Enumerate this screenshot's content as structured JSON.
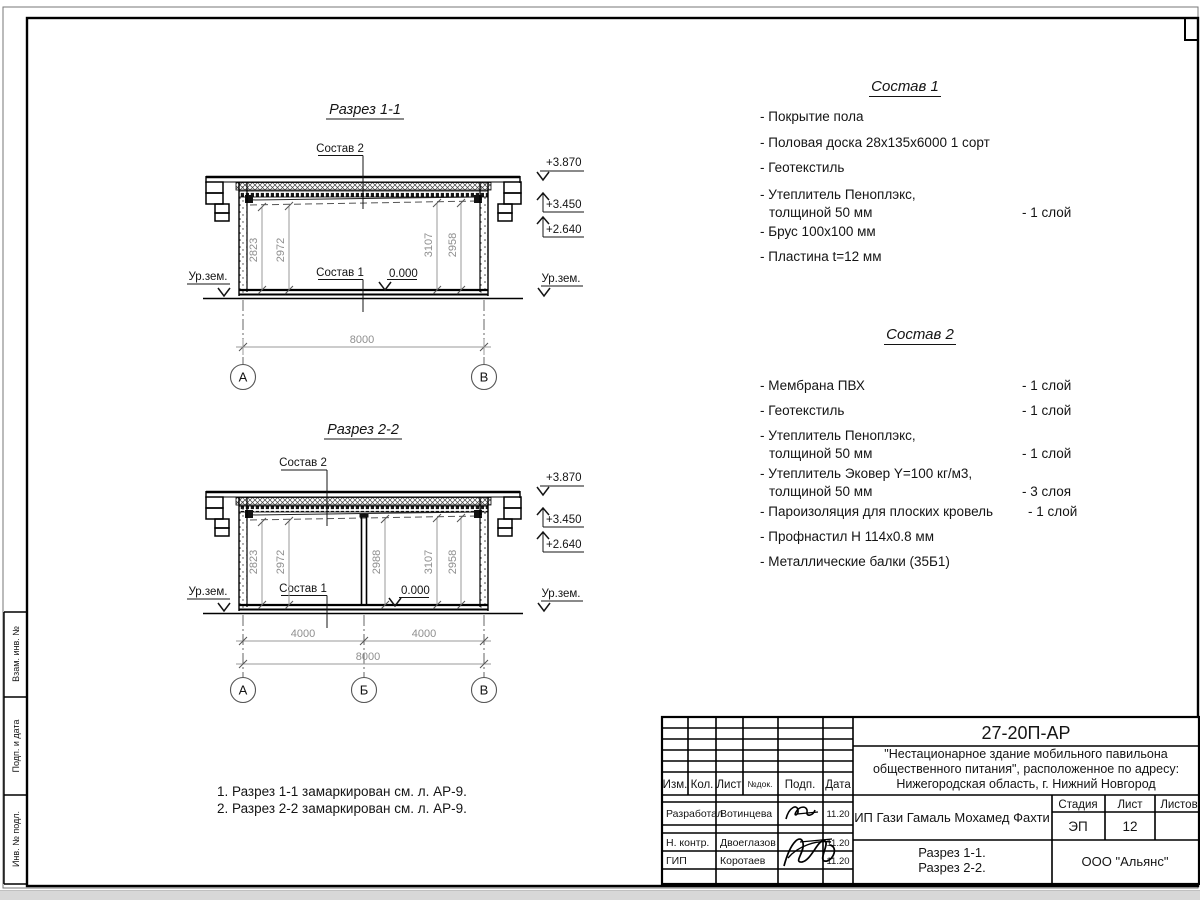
{
  "margin_labels": [
    "Взам. инв. №",
    "Подп. и дата",
    "Инв. № подл."
  ],
  "sections": [
    {
      "title": "Разрез 1-1",
      "sostav2": "Состав 2",
      "sostav1": "Состав 1",
      "zero": "0.000",
      "ground_left": "Ур.зем.",
      "ground_right": "Ур.зем.",
      "elevations": [
        "+3.870",
        "+3.450",
        "+2.640"
      ],
      "dims": [
        "2823",
        "2972",
        "3107",
        "2958"
      ],
      "span_dims": [
        "8000"
      ],
      "axes": [
        "А",
        "В"
      ]
    },
    {
      "title": "Разрез 2-2",
      "sostav2": "Состав 2",
      "sostav1": "Состав 1",
      "zero": "0.000",
      "ground_left": "Ур.зем.",
      "ground_right": "Ур.зем.",
      "elevations": [
        "+3.870",
        "+3.450",
        "+2.640"
      ],
      "dims": [
        "2823",
        "2972",
        "2988",
        "3107",
        "2958"
      ],
      "span_dims": [
        "4000",
        "4000",
        "8000"
      ],
      "axes": [
        "А",
        "Б",
        "В"
      ]
    }
  ],
  "compositions": [
    {
      "title": "Состав 1",
      "items": [
        {
          "line1": "- Покрытие пола",
          "line2": "",
          "qty": ""
        },
        {
          "line1": "- Половая доска 28х135х6000 1 сорт",
          "line2": "",
          "qty": ""
        },
        {
          "line1": "- Геотекстиль",
          "line2": "",
          "qty": ""
        },
        {
          "line1": "- Утеплитель Пеноплэкс,",
          "line2": "толщиной 50 мм",
          "qty": "- 1 слой"
        },
        {
          "line1": "- Брус 100х100 мм",
          "line2": "",
          "qty": ""
        },
        {
          "line1": "- Пластина t=12 мм",
          "line2": "",
          "qty": ""
        }
      ]
    },
    {
      "title": "Состав 2",
      "items": [
        {
          "line1": "- Мембрана ПВХ",
          "line2": "",
          "qty": "- 1 слой"
        },
        {
          "line1": "- Геотекстиль",
          "line2": "",
          "qty": "- 1 слой"
        },
        {
          "line1": "- Утеплитель Пеноплэкс,",
          "line2": "толщиной 50 мм",
          "qty": "- 1 слой"
        },
        {
          "line1": "- Утеплитель Эковер Y=100 кг/м3,",
          "line2": "толщиной 50 мм",
          "qty": "- 3 слоя"
        },
        {
          "line1": "- Пароизоляция для плоских кровель",
          "line2": "",
          "qty": "- 1 слой"
        },
        {
          "line1": "- Профнастил Н 114х0.8 мм",
          "line2": "",
          "qty": ""
        },
        {
          "line1": "- Металлические балки (35Б1)",
          "line2": "",
          "qty": ""
        }
      ]
    }
  ],
  "notes": [
    "1. Разрез 1-1 замаркирован см. л. АР-9.",
    "2. Разрез 2-2 замаркирован см. л. АР-9."
  ],
  "title_block": {
    "doc_code": "27-20П-АР",
    "project": [
      "\"Нестационарное здание мобильного павильона",
      "общественного питания\", расположенное по адресу:",
      "Нижегородская область, г. Нижний Новгород"
    ],
    "client": "ИП Гази Гамаль Мохамед Фахти",
    "sheet_name": [
      "Разрез 1-1.",
      "Разрез 2-2."
    ],
    "company": "ООО \"Альянс\"",
    "cols": [
      "Изм.",
      "Кол.",
      "Лист",
      "№док.",
      "Подп.",
      "Дата"
    ],
    "stage_cols": [
      "Стадия",
      "Лист",
      "Листов"
    ],
    "stage": "ЭП",
    "sheet": "12",
    "sheets": "",
    "rows": [
      {
        "role": "Разработал",
        "name": "Вотинцева",
        "date": "11.20"
      },
      {
        "role": "Н. контр.",
        "name": "Двоеглазов",
        "date": "11.20"
      },
      {
        "role": "ГИП",
        "name": "Коротаев",
        "date": "11.20"
      }
    ]
  }
}
